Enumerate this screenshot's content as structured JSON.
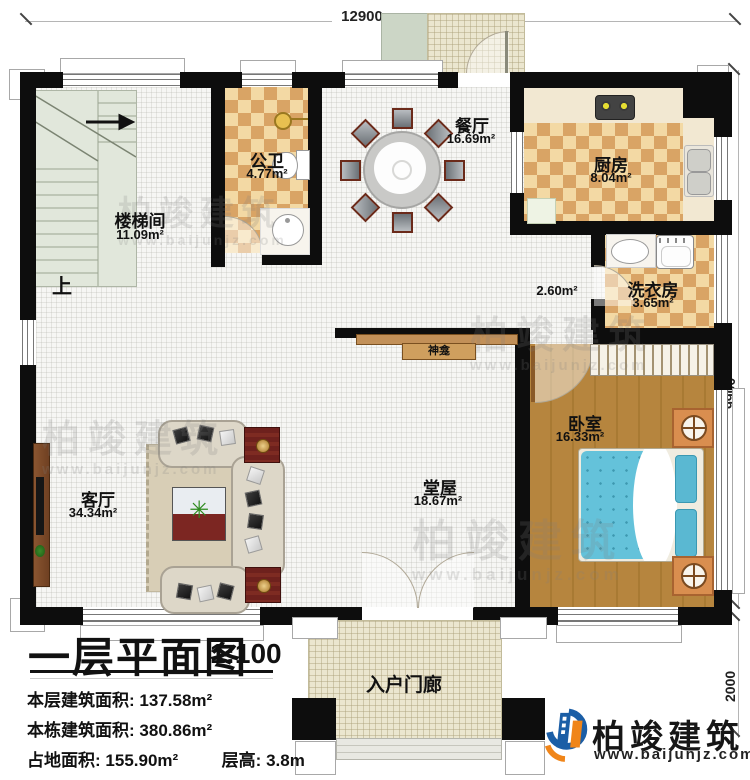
{
  "dims": {
    "top": "12900",
    "right": "9900",
    "porch": "2000"
  },
  "rooms": {
    "stairwell": {
      "name": "楼梯间",
      "area": "11.09m²"
    },
    "bathroom": {
      "name": "公卫",
      "area": "4.77m²"
    },
    "dining": {
      "name": "餐厅",
      "area": "16.69m²"
    },
    "kitchen": {
      "name": "厨房",
      "area": "8.04m²"
    },
    "laundry": {
      "name": "洗衣房",
      "area": "3.65m²"
    },
    "corridor": {
      "area": "2.60m²"
    },
    "hall": {
      "name": "堂屋",
      "area": "18.67m²"
    },
    "living": {
      "name": "客厅",
      "area": "34.34m²"
    },
    "bedroom": {
      "name": "卧室",
      "area": "16.33m²"
    },
    "porch": {
      "name": "入户门廊"
    }
  },
  "labels": {
    "shrine": "神龛",
    "up": "上"
  },
  "titleblock": {
    "title": "一层平面图",
    "scale": "1:100",
    "stats": [
      {
        "label": "本层建筑面积:",
        "value": "137.58m²"
      },
      {
        "label": "本栋建筑面积:",
        "value": "380.86m²"
      },
      {
        "label": "占地面积:",
        "value": "155.90m²"
      },
      {
        "label": "层高:",
        "value": "3.8m"
      }
    ]
  },
  "brand": {
    "name": "柏竣建筑",
    "url": "www.baijunjz.com"
  },
  "watermark": {
    "name": "柏竣建筑",
    "url": "www.baijunjz.com"
  },
  "colors": {
    "wall": "#0d0d0d",
    "checker_dark": "#d9a465",
    "checker_light": "#f3d9a4",
    "wood_floor": "#b6853e",
    "bed_blue": "#64c2da",
    "logo_blue": "#1b5ea6",
    "logo_orange": "#f08519"
  }
}
